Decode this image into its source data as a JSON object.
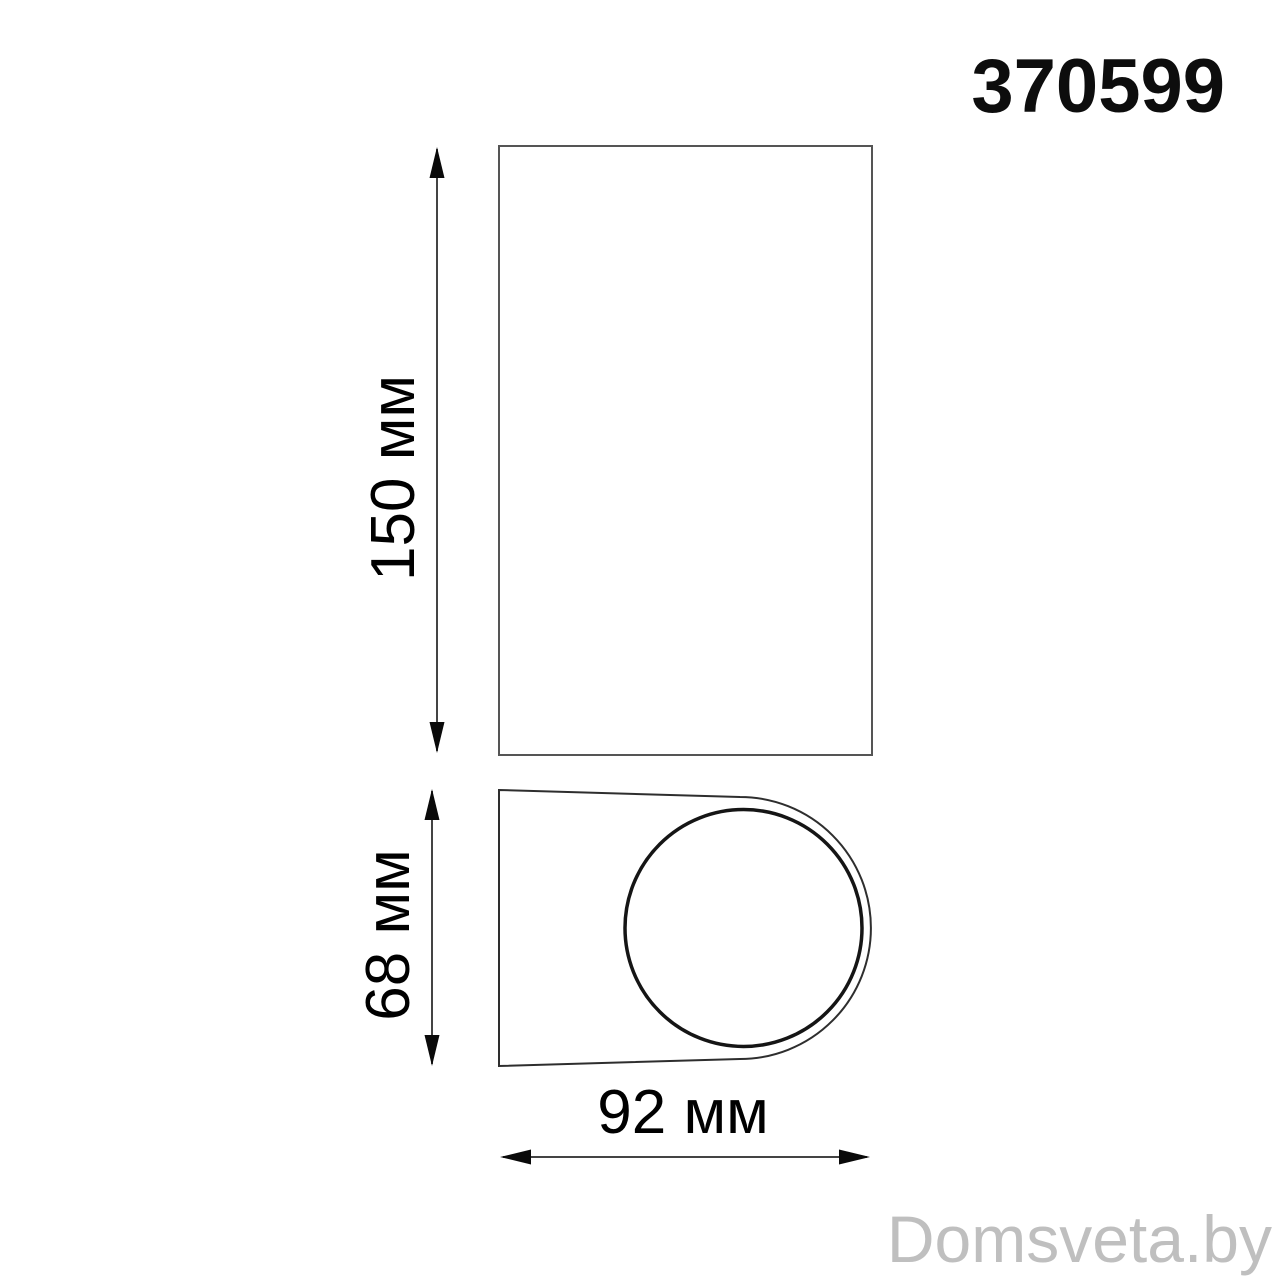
{
  "header": {
    "product_code": "370599"
  },
  "views": {
    "front": {
      "height_label": "150 мм"
    },
    "top": {
      "depth_label": "68 мм",
      "width_label": "92 мм"
    }
  },
  "dimensions": {
    "height_mm": 150,
    "depth_mm": 68,
    "width_mm": 92,
    "unit": "мм"
  },
  "watermark": {
    "text": "Domsveta.by",
    "color": "#bfbfbf"
  },
  "colors": {
    "outline": "#555555",
    "body_outline": "#2e2e2e",
    "dimension_line": "#444444",
    "arrow": "#0a0a0a",
    "label_text": "#000000",
    "background": "#ffffff"
  }
}
